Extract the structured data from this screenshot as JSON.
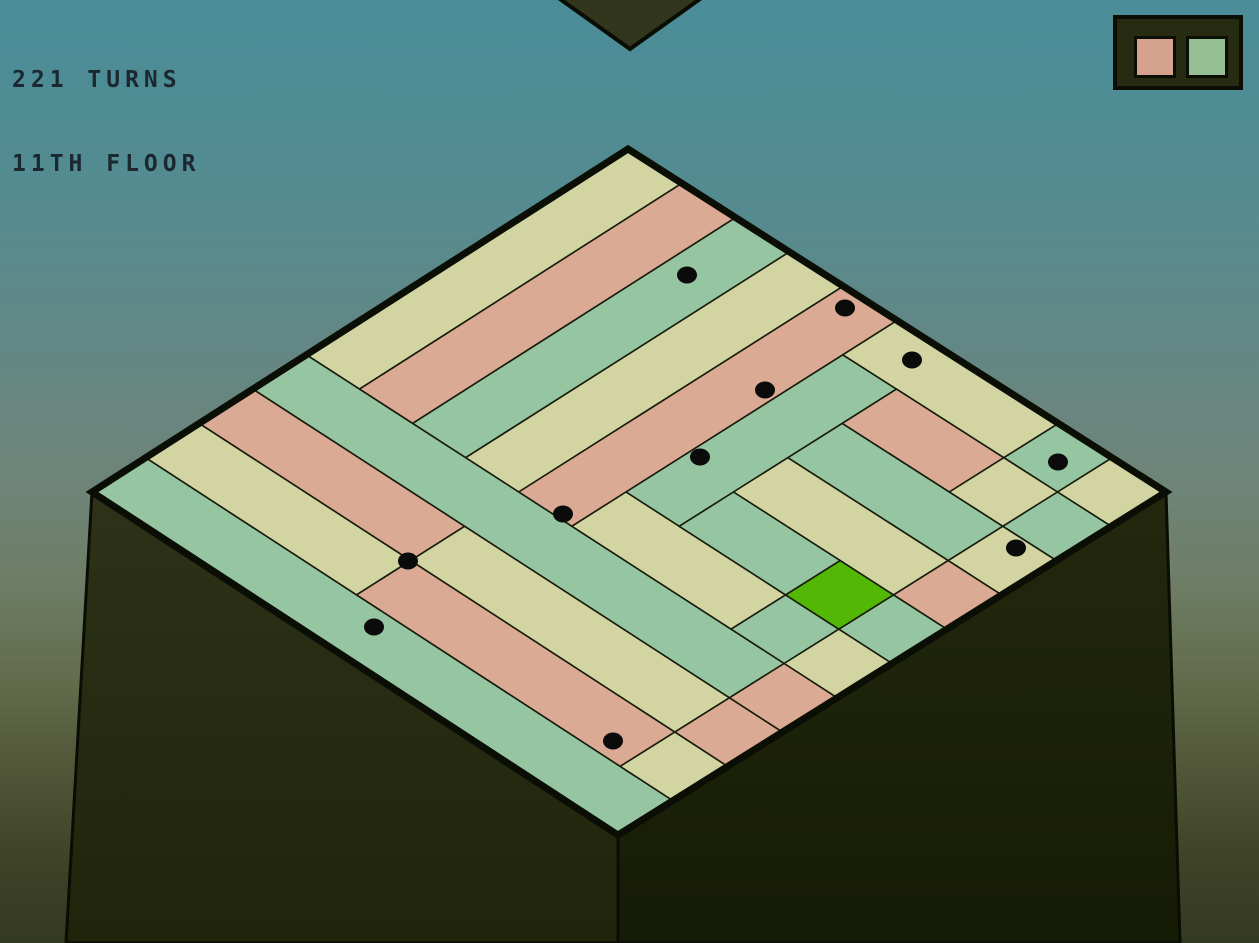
{
  "hud": {
    "turns": "221 TURNS",
    "floor": "11TH FLOOR",
    "text_color": "#1b2830"
  },
  "legend": {
    "colors": [
      {
        "name": "salmon",
        "hex": "#d4a28d"
      },
      {
        "name": "green",
        "hex": "#96bf94"
      }
    ]
  },
  "board": {
    "grid_size": 10,
    "corners": {
      "top": [
        628,
        149
      ],
      "right": [
        1166,
        492
      ],
      "bottom": [
        618,
        835
      ],
      "left": [
        92,
        492
      ]
    },
    "palette": {
      "cream": "#d2d5a2",
      "salmon": "#dbaa94",
      "mint": "#96c6a1",
      "player": "#53b705",
      "line": "#181c0c",
      "rim": "#0b0e05",
      "face_left_top": "#2d3218",
      "face_left_bottom": "#1f240b",
      "face_right_top": "#23280e",
      "face_right_bottom": "#161b05",
      "upper_floor": "#32361c",
      "dot": "#0b0b0b"
    },
    "runs": [
      {
        "c": 0,
        "r": 0,
        "w": 1,
        "h": 6,
        "color": "cream"
      },
      {
        "c": 1,
        "r": 0,
        "w": 1,
        "h": 6,
        "color": "salmon"
      },
      {
        "c": 2,
        "r": 0,
        "w": 1,
        "h": 6,
        "color": "mint"
      },
      {
        "c": 3,
        "r": 0,
        "w": 1,
        "h": 6,
        "color": "cream"
      },
      {
        "c": 4,
        "r": 0,
        "w": 1,
        "h": 6,
        "color": "salmon"
      },
      {
        "c": 5,
        "r": 1,
        "w": 1,
        "h": 4,
        "color": "mint"
      },
      {
        "c": 5,
        "r": 0,
        "w": 3,
        "h": 1,
        "color": "cream"
      },
      {
        "c": 5,
        "r": 5,
        "w": 3,
        "h": 1,
        "color": "cream"
      },
      {
        "c": 8,
        "r": 0,
        "w": 1,
        "h": 1,
        "color": "mint"
      },
      {
        "c": 9,
        "r": 0,
        "w": 1,
        "h": 1,
        "color": "cream"
      },
      {
        "c": 6,
        "r": 1,
        "w": 2,
        "h": 1,
        "color": "salmon"
      },
      {
        "c": 8,
        "r": 1,
        "w": 1,
        "h": 1,
        "color": "cream"
      },
      {
        "c": 9,
        "r": 1,
        "w": 1,
        "h": 1,
        "color": "mint"
      },
      {
        "c": 6,
        "r": 2,
        "w": 3,
        "h": 1,
        "color": "mint"
      },
      {
        "c": 9,
        "r": 2,
        "w": 1,
        "h": 1,
        "color": "cream"
      },
      {
        "c": 6,
        "r": 3,
        "w": 3,
        "h": 1,
        "color": "cream"
      },
      {
        "c": 9,
        "r": 3,
        "w": 1,
        "h": 1,
        "color": "salmon"
      },
      {
        "c": 6,
        "r": 4,
        "w": 2,
        "h": 1,
        "color": "mint"
      },
      {
        "c": 9,
        "r": 4,
        "w": 1,
        "h": 1,
        "color": "mint"
      },
      {
        "c": 8,
        "r": 5,
        "w": 1,
        "h": 1,
        "color": "mint"
      },
      {
        "c": 9,
        "r": 5,
        "w": 1,
        "h": 1,
        "color": "cream"
      },
      {
        "c": 0,
        "r": 6,
        "w": 9,
        "h": 1,
        "color": "mint"
      },
      {
        "c": 9,
        "r": 6,
        "w": 1,
        "h": 1,
        "color": "salmon"
      },
      {
        "c": 0,
        "r": 7,
        "w": 4,
        "h": 1,
        "color": "salmon"
      },
      {
        "c": 4,
        "r": 7,
        "w": 5,
        "h": 1,
        "color": "cream"
      },
      {
        "c": 9,
        "r": 7,
        "w": 1,
        "h": 1,
        "color": "salmon"
      },
      {
        "c": 0,
        "r": 8,
        "w": 4,
        "h": 1,
        "color": "cream"
      },
      {
        "c": 4,
        "r": 8,
        "w": 5,
        "h": 1,
        "color": "salmon"
      },
      {
        "c": 9,
        "r": 8,
        "w": 1,
        "h": 1,
        "color": "cream"
      },
      {
        "c": 0,
        "r": 9,
        "w": 10,
        "h": 1,
        "color": "mint"
      }
    ],
    "player": {
      "c": 8,
      "r": 4
    },
    "dots": [
      [
        687,
        275
      ],
      [
        845,
        308
      ],
      [
        912,
        360
      ],
      [
        765,
        390
      ],
      [
        700,
        457
      ],
      [
        1058,
        462
      ],
      [
        563,
        514
      ],
      [
        1016,
        548
      ],
      [
        408,
        561
      ],
      [
        374,
        627
      ],
      [
        613,
        741
      ]
    ]
  }
}
